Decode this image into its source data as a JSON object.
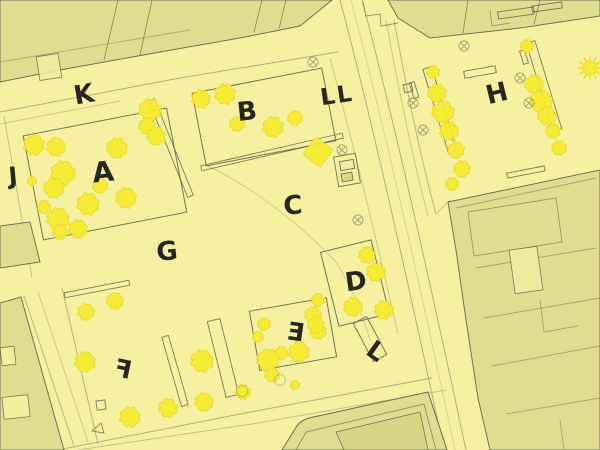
{
  "app": {
    "type": "landscape-site-plan",
    "description": "Yellow-washed urban square site plan with stamped letter area labels"
  },
  "palette": {
    "bg": "#f5f1a0",
    "context_fill": "#e1dd90",
    "context_inner_fill": "#d8d484",
    "light_fill": "#f0eca0",
    "context_stroke": "#6e6e52",
    "design_stroke": "#5f5f46",
    "road_stroke": "#a29f7c",
    "tree_fill": "#f7eb30",
    "tree_stroke": "#e5d62c",
    "symbol_stroke": "#8d8d68",
    "label_color": "#161616"
  },
  "area_labels": [
    {
      "text": "K",
      "x": 84,
      "y": 95,
      "size": 26,
      "rot": -10,
      "flip": false
    },
    {
      "text": "B",
      "x": 247,
      "y": 112,
      "size": 26,
      "rot": -6,
      "flip": false
    },
    {
      "text": "LL",
      "x": 337,
      "y": 96,
      "size": 23,
      "rot": -8,
      "flip": false
    },
    {
      "text": "H",
      "x": 497,
      "y": 94,
      "size": 26,
      "rot": -14,
      "flip": false
    },
    {
      "text": "J",
      "x": 13,
      "y": 176,
      "size": 24,
      "rot": -5,
      "flip": false
    },
    {
      "text": "A",
      "x": 103,
      "y": 172,
      "size": 28,
      "rot": -6,
      "flip": false
    },
    {
      "text": "C",
      "x": 293,
      "y": 206,
      "size": 26,
      "rot": -4,
      "flip": false
    },
    {
      "text": "G",
      "x": 167,
      "y": 252,
      "size": 26,
      "rot": -5,
      "flip": false
    },
    {
      "text": "D",
      "x": 356,
      "y": 282,
      "size": 26,
      "rot": -8,
      "flip": false
    },
    {
      "text": "E",
      "x": 296,
      "y": 332,
      "size": 25,
      "rot": 8,
      "flip": true
    },
    {
      "text": "F",
      "x": 123,
      "y": 369,
      "size": 25,
      "rot": 12,
      "flip": true
    },
    {
      "text": "L",
      "x": 376,
      "y": 351,
      "size": 25,
      "rot": 35,
      "flip": false
    }
  ],
  "map": {
    "context_buildings": [
      {
        "name": "block-top-left",
        "points": "0,0 332,0 300,26 240,38 160,52 60,70 0,82"
      },
      {
        "name": "block-top-right",
        "points": "388,0 600,0 600,16 520,28 466,34 430,38 398,18"
      },
      {
        "name": "block-east",
        "points": "448,202 600,170 600,450 490,450 478,398 466,320 456,250"
      },
      {
        "name": "block-bottom-left",
        "points": "0,303 21,297 64,450 0,450"
      },
      {
        "name": "block-left-mid",
        "points": "0,226 30,222 40,262 0,268"
      }
    ],
    "bottom_building": {
      "outer": "M 282,450 L 295,429 Q 299,421 309,418 L 428,392 L 447,450 Z",
      "inner_line": "296,450 306,432 424,404 436,450",
      "inner_rect": "336,432 420,412 428,450 344,450"
    },
    "building_detail_lines": [
      {
        "points": "118,0 104,60",
        "op": 0.7
      },
      {
        "points": "152,0 140,55",
        "op": 0.7
      },
      {
        "points": "262,0 254,32",
        "op": 0.7
      },
      {
        "points": "286,0 279,29",
        "op": 0.7
      },
      {
        "points": "0,62 190,30",
        "op": 0.45
      },
      {
        "points": "363,2 366,16 380,14 381,26 398,23",
        "op": 0.7
      },
      {
        "points": "468,0 463,33",
        "op": 0.7
      },
      {
        "points": "540,0 534,24",
        "op": 0.7
      },
      {
        "points": "490,10 492,26 510,23",
        "op": 0.6
      },
      {
        "points": "468,212 556,198 562,242 474,256 468,212",
        "op": 0.6
      },
      {
        "points": "476,268 596,248",
        "op": 0.5
      },
      {
        "points": "484,318 600,298",
        "op": 0.5
      },
      {
        "points": "540,300 544,332 578,326",
        "op": 0.5
      },
      {
        "points": "492,366 600,346",
        "op": 0.5
      },
      {
        "points": "506,414 600,398",
        "op": 0.5
      },
      {
        "points": "560,420 564,450",
        "op": 0.5
      },
      {
        "points": "456,208 596,178",
        "op": 0.5
      }
    ],
    "building_detail_rects": [
      {
        "name": "courtyard-notch",
        "cx": 49,
        "cy": 67,
        "w": 22,
        "h": 24,
        "rot": -9,
        "fill": "light"
      },
      {
        "name": "inner-building",
        "cx": 526,
        "cy": 270,
        "w": 28,
        "h": 44,
        "rot": -8,
        "fill": "light"
      },
      {
        "name": "courtyard-sq-1",
        "cx": 8,
        "cy": 356,
        "w": 14,
        "h": 18,
        "rot": -6,
        "fill": "bg"
      },
      {
        "name": "courtyard-sq-2",
        "cx": 16,
        "cy": 407,
        "w": 26,
        "h": 22,
        "rot": -6,
        "fill": "bg"
      }
    ],
    "roads": [
      {
        "name": "north-street-kerb",
        "d": "M 0,112 L 180,78 L 338,52",
        "op": 0.8
      },
      {
        "name": "north-street-kerb-2",
        "d": "M 0,124 L 120,101",
        "op": 0.5
      },
      {
        "name": "main-road-west-kerb",
        "d": "M 340,0 C 372,120 412,300 444,450",
        "op": 0.8
      },
      {
        "name": "main-road-east-kerb",
        "d": "M 362,0 C 394,120 434,300 466,450",
        "op": 0.8
      },
      {
        "name": "main-road-centre",
        "d": "M 351,0 C 383,120 423,300 455,450",
        "op": 0.35
      },
      {
        "name": "south-street-kerb",
        "d": "M 58,450 L 240,414 L 432,378",
        "op": 0.8
      },
      {
        "name": "south-street-kerb-2",
        "d": "M 78,450 L 252,424 L 446,390",
        "op": 0.6
      },
      {
        "name": "west-street-kerb",
        "d": "M 4,116 L 32,278",
        "op": 0.6
      },
      {
        "name": "sw-street-kerb",
        "d": "M 24,296 L 74,446",
        "op": 0.7
      },
      {
        "name": "sw-street-kerb-2",
        "d": "M 38,292 L 88,442",
        "op": 0.5
      },
      {
        "name": "f-area-west-edge",
        "d": "M 62,288 L 98,444",
        "op": 0.75
      },
      {
        "name": "h-court-west-edge",
        "d": "M 394,20 C 406,86 420,156 436,214",
        "op": 0.7
      },
      {
        "name": "h-court-west-edge-2",
        "d": "M 386,20 C 398,86 412,156 428,216",
        "op": 0.5
      },
      {
        "name": "plaza-east-curve",
        "d": "M 330,58 C 352,140 378,246 398,334",
        "op": 0.5
      },
      {
        "name": "plaza-arc-1",
        "d": "M 208,166 C 258,190 304,228 336,262",
        "op": 0.45
      },
      {
        "name": "plaza-arc-2",
        "d": "M 336,262 C 352,288 362,312 370,340",
        "op": 0.45
      },
      {
        "name": "h-court-corner",
        "d": "M 436,214 L 450,200",
        "op": 0.5
      }
    ],
    "design_blocks": [
      {
        "name": "field-A",
        "cx": 105,
        "cy": 174,
        "w": 146,
        "h": 106,
        "rot": -11
      },
      {
        "name": "field-B",
        "cx": 264,
        "cy": 117,
        "w": 132,
        "h": 74,
        "rot": -11
      },
      {
        "name": "field-D",
        "cx": 355,
        "cy": 283,
        "w": 52,
        "h": 76,
        "rot": -14
      },
      {
        "name": "field-E",
        "cx": 293,
        "cy": 334,
        "w": 78,
        "h": 60,
        "rot": -10
      },
      {
        "name": "ramp-L",
        "cx": 370,
        "cy": 339,
        "w": 15,
        "h": 43,
        "rot": -28
      }
    ],
    "slim_elements": [
      {
        "name": "wall-K",
        "cx": 171,
        "cy": 148,
        "w": 6,
        "h": 104,
        "rot": -22
      },
      {
        "name": "wall-B",
        "cx": 272,
        "cy": 152,
        "w": 145,
        "h": 5,
        "rot": -13
      },
      {
        "name": "wall-F",
        "cx": 97,
        "cy": 289,
        "w": 66,
        "h": 5,
        "rot": -11
      },
      {
        "name": "bed-F-1",
        "cx": 175,
        "cy": 371,
        "w": 7,
        "h": 72,
        "rot": -16
      },
      {
        "name": "bed-F-2",
        "cx": 223,
        "cy": 358,
        "w": 13,
        "h": 78,
        "rot": -14
      },
      {
        "name": "bed-H-1",
        "cx": 440,
        "cy": 110,
        "w": 9,
        "h": 88,
        "rot": -17
      },
      {
        "name": "bed-H-2",
        "cx": 544,
        "cy": 86,
        "w": 9,
        "h": 92,
        "rot": -17
      },
      {
        "name": "bench-1",
        "cx": 414,
        "cy": 90,
        "w": 5,
        "h": 16,
        "rot": -17
      },
      {
        "name": "bench-2",
        "cx": 524,
        "cy": 57,
        "w": 5,
        "h": 14,
        "rot": -17
      },
      {
        "name": "bench-3",
        "cx": 480,
        "cy": 72,
        "w": 32,
        "h": 7,
        "rot": -10
      },
      {
        "name": "bench-4",
        "cx": 516,
        "cy": 13,
        "w": 36,
        "h": 7,
        "rot": -8
      },
      {
        "name": "bench-5",
        "cx": 547,
        "cy": 7,
        "w": 30,
        "h": 6,
        "rot": -8
      },
      {
        "name": "bench-6",
        "cx": 526,
        "cy": 172,
        "w": 38,
        "h": 5,
        "rot": -11
      }
    ],
    "structures": [
      {
        "name": "kiosk-outer",
        "cx": 347,
        "cy": 170,
        "w": 22,
        "h": 30,
        "rot": -10,
        "fill": "none"
      },
      {
        "name": "kiosk-top",
        "cx": 347,
        "cy": 165,
        "w": 14,
        "h": 9,
        "rot": -10,
        "fill": "light"
      },
      {
        "name": "kiosk-base",
        "cx": 347,
        "cy": 177,
        "w": 11,
        "h": 8,
        "rot": -10,
        "fill": "inner"
      },
      {
        "name": "small-square-h",
        "cx": 408,
        "cy": 88,
        "w": 8,
        "h": 8,
        "rot": -10,
        "fill": "none"
      },
      {
        "name": "small-square-f",
        "cx": 101,
        "cy": 405,
        "w": 9,
        "h": 9,
        "rot": -8,
        "fill": "none"
      }
    ],
    "small_triangles": [
      {
        "name": "mark-f",
        "points": "92,431 101,423 104,433"
      }
    ],
    "trees_round": [
      [
        34,
        145,
        11
      ],
      [
        56,
        147,
        10
      ],
      [
        117,
        148,
        11
      ],
      [
        150,
        110,
        12
      ],
      [
        147,
        126,
        9
      ],
      [
        156,
        136,
        10
      ],
      [
        63,
        173,
        13
      ],
      [
        54,
        188,
        11
      ],
      [
        32,
        181,
        5
      ],
      [
        44,
        207,
        7
      ],
      [
        100,
        186,
        8
      ],
      [
        88,
        204,
        12
      ],
      [
        126,
        198,
        11
      ],
      [
        58,
        219,
        12
      ],
      [
        78,
        229,
        10
      ],
      [
        60,
        232,
        8
      ],
      [
        201,
        99,
        10
      ],
      [
        225,
        94,
        11
      ],
      [
        237,
        124,
        8
      ],
      [
        273,
        127,
        11
      ],
      [
        295,
        118,
        8
      ],
      [
        367,
        255,
        9
      ],
      [
        376,
        272,
        10
      ],
      [
        353,
        307,
        10
      ],
      [
        384,
        310,
        10
      ],
      [
        264,
        324,
        7
      ],
      [
        258,
        337,
        6
      ],
      [
        313,
        315,
        9
      ],
      [
        318,
        331,
        9
      ],
      [
        299,
        352,
        11
      ],
      [
        281,
        353,
        7
      ],
      [
        268,
        360,
        12
      ],
      [
        318,
        300,
        7
      ],
      [
        316,
        325,
        9
      ],
      [
        86,
        312,
        9
      ],
      [
        115,
        301,
        9
      ],
      [
        85,
        362,
        11
      ],
      [
        130,
        417,
        11
      ],
      [
        168,
        408,
        10
      ],
      [
        204,
        402,
        10
      ],
      [
        202,
        361,
        12
      ],
      [
        243,
        392,
        8
      ],
      [
        272,
        375,
        8
      ],
      [
        295,
        385,
        5
      ],
      [
        433,
        72,
        7
      ],
      [
        437,
        93,
        10
      ],
      [
        443,
        112,
        12
      ],
      [
        449,
        131,
        10
      ],
      [
        456,
        150,
        9
      ],
      [
        462,
        169,
        9
      ],
      [
        452,
        184,
        7
      ],
      [
        527,
        46,
        7
      ],
      [
        534,
        84,
        10
      ],
      [
        541,
        101,
        12
      ],
      [
        547,
        116,
        10
      ],
      [
        553,
        131,
        8
      ],
      [
        559,
        148,
        8
      ]
    ],
    "trees_square": [
      {
        "x": 318,
        "y": 152,
        "r": 11,
        "rot": 38
      }
    ],
    "trees_star": [
      {
        "x": 590,
        "y": 68,
        "r": 13
      }
    ],
    "symbols_circle_x": [
      [
        313,
        62
      ],
      [
        342,
        150
      ],
      [
        358,
        220
      ],
      [
        413,
        103
      ],
      [
        423,
        130
      ],
      [
        520,
        78
      ],
      [
        529,
        103
      ],
      [
        464,
        46
      ]
    ],
    "symbols_circle": [
      [
        280,
        380
      ],
      [
        242,
        391
      ]
    ]
  }
}
